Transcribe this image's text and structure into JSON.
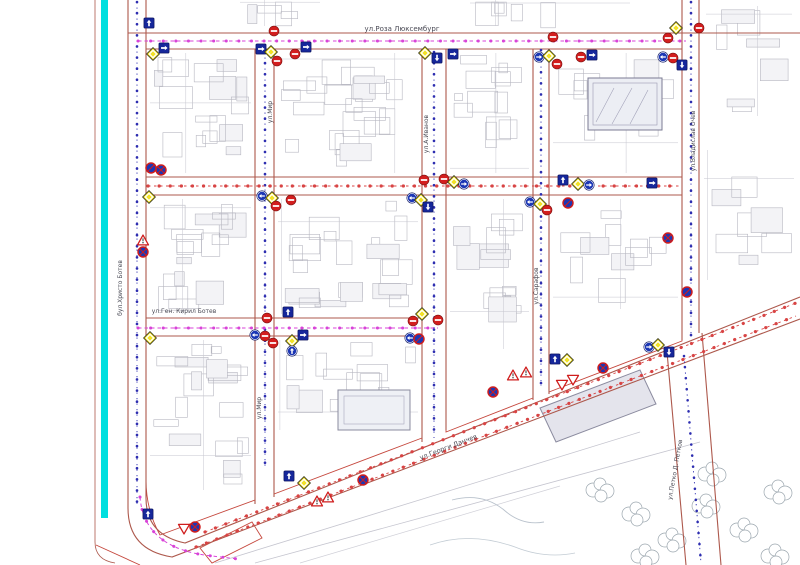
{
  "map": {
    "streets": {
      "roza_luxemburg": "ул.Роза Люксембург",
      "mir_north": "ул.Мир",
      "mir_south": "ул.Мир",
      "a_ivanov": "ул.А.Иванов",
      "sarafov": "ул.Сарафов",
      "vladislav_ochev": "ул.Владислав Очев",
      "hristo_botev": "бул.Христо Ботев",
      "gen_kiril_botev": "ул.Ген. Кирил Ботев",
      "georgi_danchev": "ул.Георги Данчев",
      "petko_petkov": "ул.Петко Д. Петков"
    },
    "colors": {
      "canal_cyan": "#00dfdf",
      "street_edge_red": "#ad584c",
      "block_outline_red": "#c5473d",
      "route_magenta": "#d843d8",
      "route_red": "#d84444",
      "line_blue": "#2d2db0",
      "sign_yellow": "#f2e226",
      "sign_red": "#d31e1e",
      "sign_blue": "#1c37b5",
      "building_gray": "#b7b7c1"
    },
    "sign_legend": {
      "priority": "priority-road-sign",
      "no-entry": "no-entry-sign",
      "sq-up": "one-way-street-sign",
      "sq-right": "one-way-right-sign",
      "sq-down": "one-way-down-sign",
      "circ-left": "mandatory-left-sign",
      "circ-right": "mandatory-right-sign",
      "circ-up": "mandatory-straight-sign",
      "no-stop": "no-stopping-sign",
      "no-park": "no-parking-sign",
      "tri-up": "warning-triangle-sign",
      "tri-down": "give-way-sign"
    },
    "signs": [
      {
        "t": "sq-up",
        "x": 149,
        "y": 23
      },
      {
        "t": "priority",
        "x": 153,
        "y": 54
      },
      {
        "t": "sq-right",
        "x": 164,
        "y": 48
      },
      {
        "t": "no-entry",
        "x": 274,
        "y": 31
      },
      {
        "t": "sq-right",
        "x": 261,
        "y": 49
      },
      {
        "t": "priority",
        "x": 271,
        "y": 52
      },
      {
        "t": "no-entry",
        "x": 277,
        "y": 61
      },
      {
        "t": "no-entry",
        "x": 295,
        "y": 54
      },
      {
        "t": "sq-right",
        "x": 306,
        "y": 47
      },
      {
        "t": "priority",
        "x": 425,
        "y": 53
      },
      {
        "t": "sq-down",
        "x": 437,
        "y": 58
      },
      {
        "t": "sq-right",
        "x": 453,
        "y": 54
      },
      {
        "t": "circ-right",
        "x": 539,
        "y": 57
      },
      {
        "t": "priority",
        "x": 549,
        "y": 56
      },
      {
        "t": "no-entry",
        "x": 557,
        "y": 64
      },
      {
        "t": "no-entry",
        "x": 553,
        "y": 37
      },
      {
        "t": "no-entry",
        "x": 581,
        "y": 57
      },
      {
        "t": "sq-right",
        "x": 592,
        "y": 55
      },
      {
        "t": "no-entry",
        "x": 668,
        "y": 38
      },
      {
        "t": "priority",
        "x": 676,
        "y": 28
      },
      {
        "t": "no-entry",
        "x": 699,
        "y": 28
      },
      {
        "t": "circ-left",
        "x": 663,
        "y": 57
      },
      {
        "t": "no-entry",
        "x": 673,
        "y": 58
      },
      {
        "t": "sq-down",
        "x": 682,
        "y": 65
      },
      {
        "t": "no-park",
        "x": 151,
        "y": 168
      },
      {
        "t": "no-stop",
        "x": 161,
        "y": 170
      },
      {
        "t": "priority",
        "x": 149,
        "y": 197
      },
      {
        "t": "circ-left",
        "x": 262,
        "y": 196
      },
      {
        "t": "priority",
        "x": 272,
        "y": 198
      },
      {
        "t": "no-entry",
        "x": 276,
        "y": 206
      },
      {
        "t": "no-entry",
        "x": 291,
        "y": 200
      },
      {
        "t": "no-entry",
        "x": 424,
        "y": 180
      },
      {
        "t": "no-entry",
        "x": 444,
        "y": 179
      },
      {
        "t": "priority",
        "x": 454,
        "y": 182
      },
      {
        "t": "circ-right",
        "x": 464,
        "y": 184
      },
      {
        "t": "circ-left",
        "x": 412,
        "y": 198
      },
      {
        "t": "priority",
        "x": 421,
        "y": 200
      },
      {
        "t": "sq-down",
        "x": 428,
        "y": 207
      },
      {
        "t": "sq-up",
        "x": 563,
        "y": 180
      },
      {
        "t": "priority",
        "x": 578,
        "y": 184
      },
      {
        "t": "circ-right",
        "x": 589,
        "y": 185
      },
      {
        "t": "circ-left",
        "x": 530,
        "y": 202
      },
      {
        "t": "priority",
        "x": 540,
        "y": 204
      },
      {
        "t": "no-entry",
        "x": 547,
        "y": 210
      },
      {
        "t": "no-park",
        "x": 568,
        "y": 203
      },
      {
        "t": "sq-right",
        "x": 652,
        "y": 183
      },
      {
        "t": "no-stop",
        "x": 668,
        "y": 238
      },
      {
        "t": "no-park",
        "x": 687,
        "y": 292
      },
      {
        "t": "no-entry",
        "x": 267,
        "y": 318
      },
      {
        "t": "sq-up",
        "x": 288,
        "y": 312
      },
      {
        "t": "circ-left",
        "x": 255,
        "y": 335
      },
      {
        "t": "no-entry",
        "x": 265,
        "y": 336
      },
      {
        "t": "no-entry",
        "x": 273,
        "y": 343
      },
      {
        "t": "priority",
        "x": 292,
        "y": 341
      },
      {
        "t": "sq-right",
        "x": 303,
        "y": 335
      },
      {
        "t": "circ-up",
        "x": 292,
        "y": 351
      },
      {
        "t": "priority",
        "x": 422,
        "y": 314
      },
      {
        "t": "no-entry",
        "x": 413,
        "y": 321
      },
      {
        "t": "no-entry",
        "x": 438,
        "y": 320
      },
      {
        "t": "circ-left",
        "x": 410,
        "y": 338
      },
      {
        "t": "no-park",
        "x": 419,
        "y": 339
      },
      {
        "t": "priority",
        "x": 150,
        "y": 338
      },
      {
        "t": "tri-up",
        "x": 143,
        "y": 240
      },
      {
        "t": "no-stop",
        "x": 143,
        "y": 252
      },
      {
        "t": "sq-up",
        "x": 148,
        "y": 514
      },
      {
        "t": "tri-down",
        "x": 184,
        "y": 529
      },
      {
        "t": "no-stop",
        "x": 195,
        "y": 527
      },
      {
        "t": "sq-up",
        "x": 289,
        "y": 476
      },
      {
        "t": "priority",
        "x": 304,
        "y": 483
      },
      {
        "t": "tri-up",
        "x": 317,
        "y": 501
      },
      {
        "t": "tri-up",
        "x": 328,
        "y": 497
      },
      {
        "t": "no-stop",
        "x": 363,
        "y": 480
      },
      {
        "t": "no-stop",
        "x": 493,
        "y": 392
      },
      {
        "t": "tri-up",
        "x": 513,
        "y": 375
      },
      {
        "t": "tri-up",
        "x": 526,
        "y": 372
      },
      {
        "t": "tri-down",
        "x": 562,
        "y": 385
      },
      {
        "t": "tri-down",
        "x": 573,
        "y": 380
      },
      {
        "t": "sq-up",
        "x": 555,
        "y": 359
      },
      {
        "t": "priority",
        "x": 567,
        "y": 360
      },
      {
        "t": "no-stop",
        "x": 603,
        "y": 368
      },
      {
        "t": "circ-right",
        "x": 649,
        "y": 347
      },
      {
        "t": "priority",
        "x": 658,
        "y": 345
      },
      {
        "t": "sq-down",
        "x": 669,
        "y": 352
      }
    ]
  }
}
